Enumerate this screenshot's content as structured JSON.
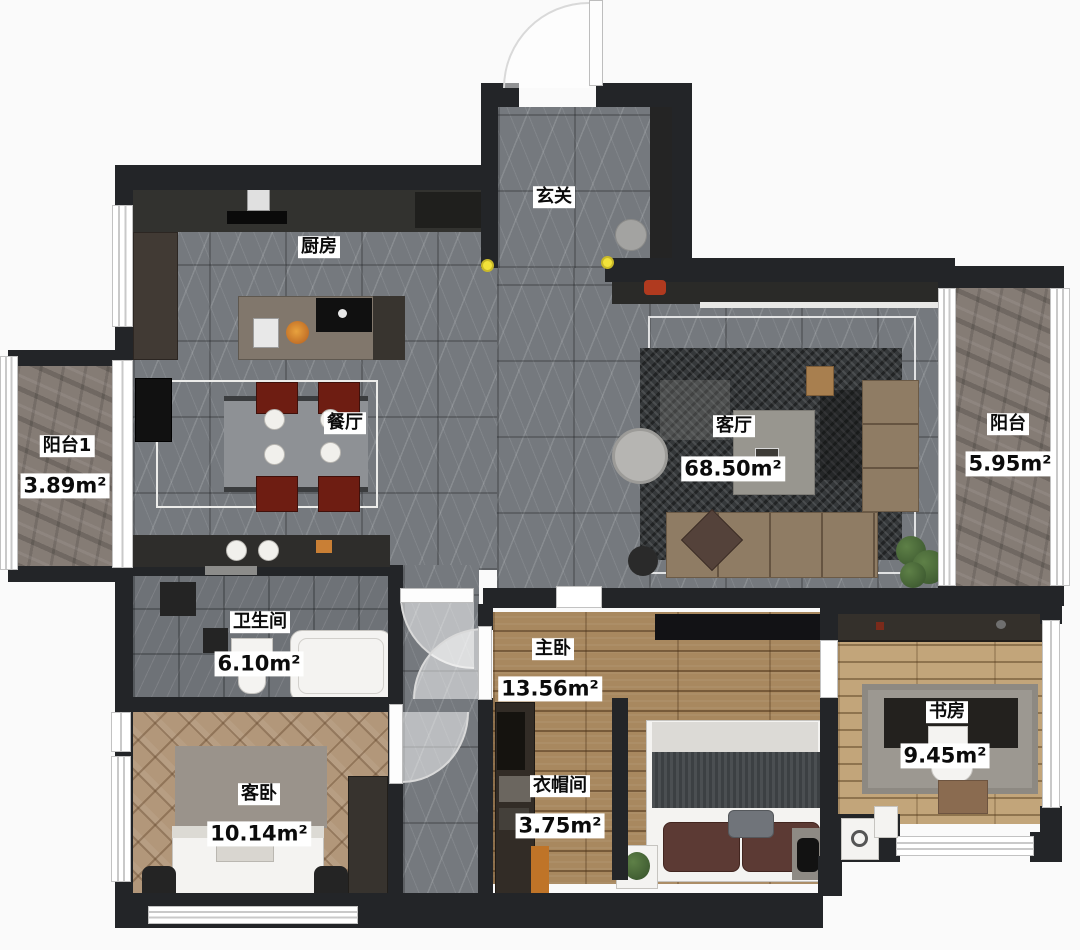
{
  "rooms": {
    "entry": {
      "name": "玄关"
    },
    "kitchen": {
      "name": "厨房"
    },
    "dining": {
      "name": "餐厅"
    },
    "living": {
      "name": "客厅",
      "area": "68.50m²"
    },
    "balcony1": {
      "name": "阳台1",
      "area": "3.89m²"
    },
    "balcony2": {
      "name": "阳台",
      "area": "5.95m²"
    },
    "bathroom": {
      "name": "卫生间",
      "area": "6.10m²"
    },
    "guest_bedroom": {
      "name": "客卧",
      "area": "10.14m²"
    },
    "master_bedroom": {
      "name": "主卧",
      "area": "13.56m²"
    },
    "closet": {
      "name": "衣帽间",
      "area": "3.75m²"
    },
    "study": {
      "name": "书房",
      "area": "9.45m²"
    }
  },
  "colors": {
    "wall": "#232528",
    "label_bg": "#ffffff",
    "label_text": "#0b0b0b",
    "marble": "#75797e",
    "wood": "#a8885f",
    "wood_light": "#c2a57a",
    "herringbone": "#b2977a",
    "stone": "#857c75",
    "rug_dark": "#35383a",
    "sofa_brown": "#8f7c64",
    "chair_red": "#6e1d12",
    "accent_orange": "#cf8b55",
    "yellow_dot": "#f2e23a"
  }
}
